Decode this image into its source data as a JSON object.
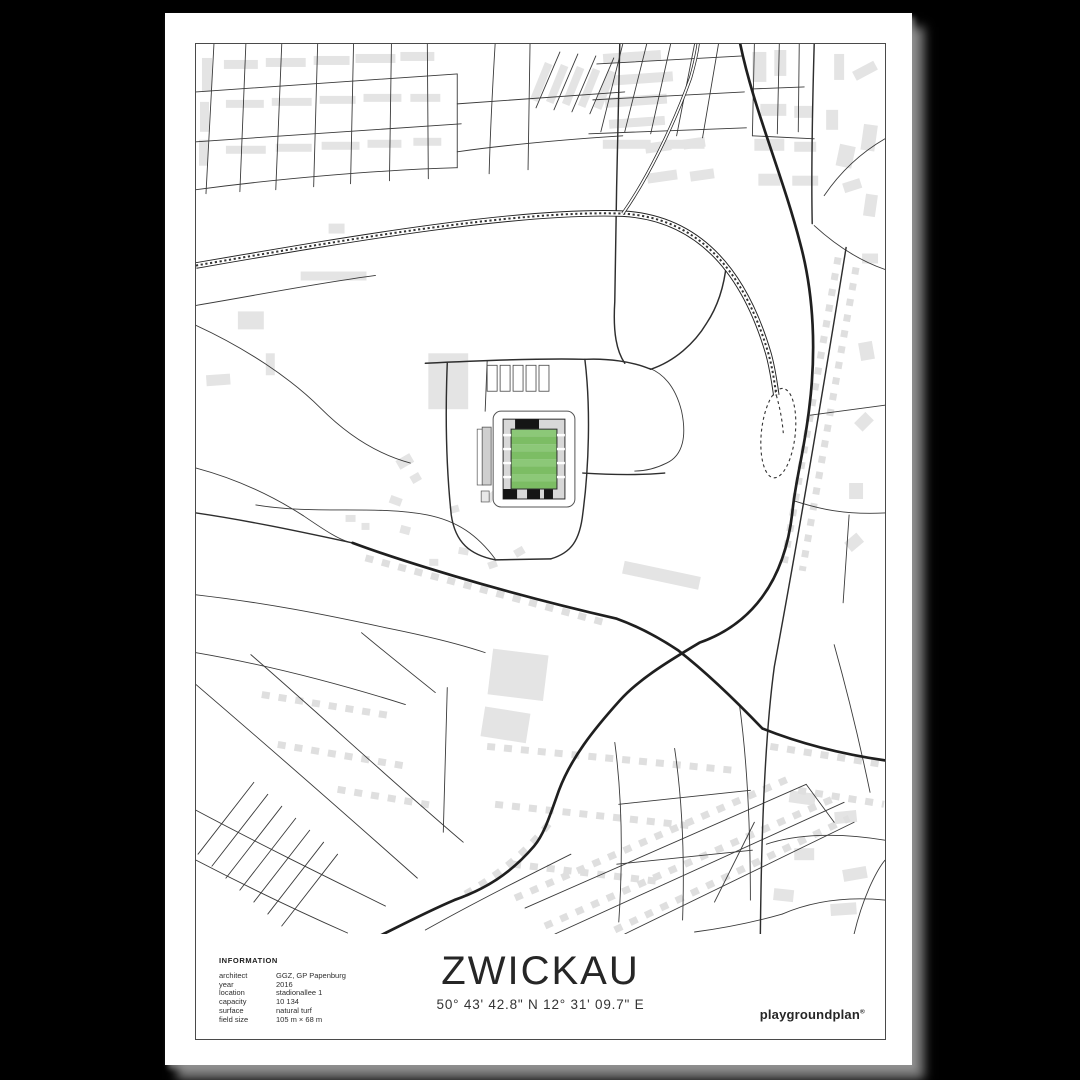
{
  "background_color": "#000000",
  "poster": {
    "title": "ZWICKAU",
    "coordinates": "50° 43' 42.8\" N 12° 31' 09.7\" E",
    "brand": "playgroundplan",
    "brand_mark": "®"
  },
  "information": {
    "heading": "INFORMATION",
    "rows": [
      {
        "label": "architect",
        "value": "GGZ, GP Papenburg"
      },
      {
        "label": "year",
        "value": "2016"
      },
      {
        "label": "location",
        "value": "stadionallee 1"
      },
      {
        "label": "capacity",
        "value": "10 134"
      },
      {
        "label": "surface",
        "value": "natural turf"
      },
      {
        "label": "field size",
        "value": "105 m × 68 m"
      }
    ]
  },
  "map": {
    "type": "minimalist-street-map",
    "landmark": "football-stadium",
    "features": [
      "streets",
      "railway-line",
      "rail-loop",
      "buildings",
      "stadium-with-pitch"
    ],
    "colors": {
      "map_background": "#ffffff",
      "roads": "#2e2e2e",
      "buildings": "#e4e4e4",
      "pitch_green_light": "#8cc878",
      "pitch_green_dark": "#7cbd64",
      "stand_dark": "#151515",
      "stand_light": "#d8d8d8"
    }
  }
}
